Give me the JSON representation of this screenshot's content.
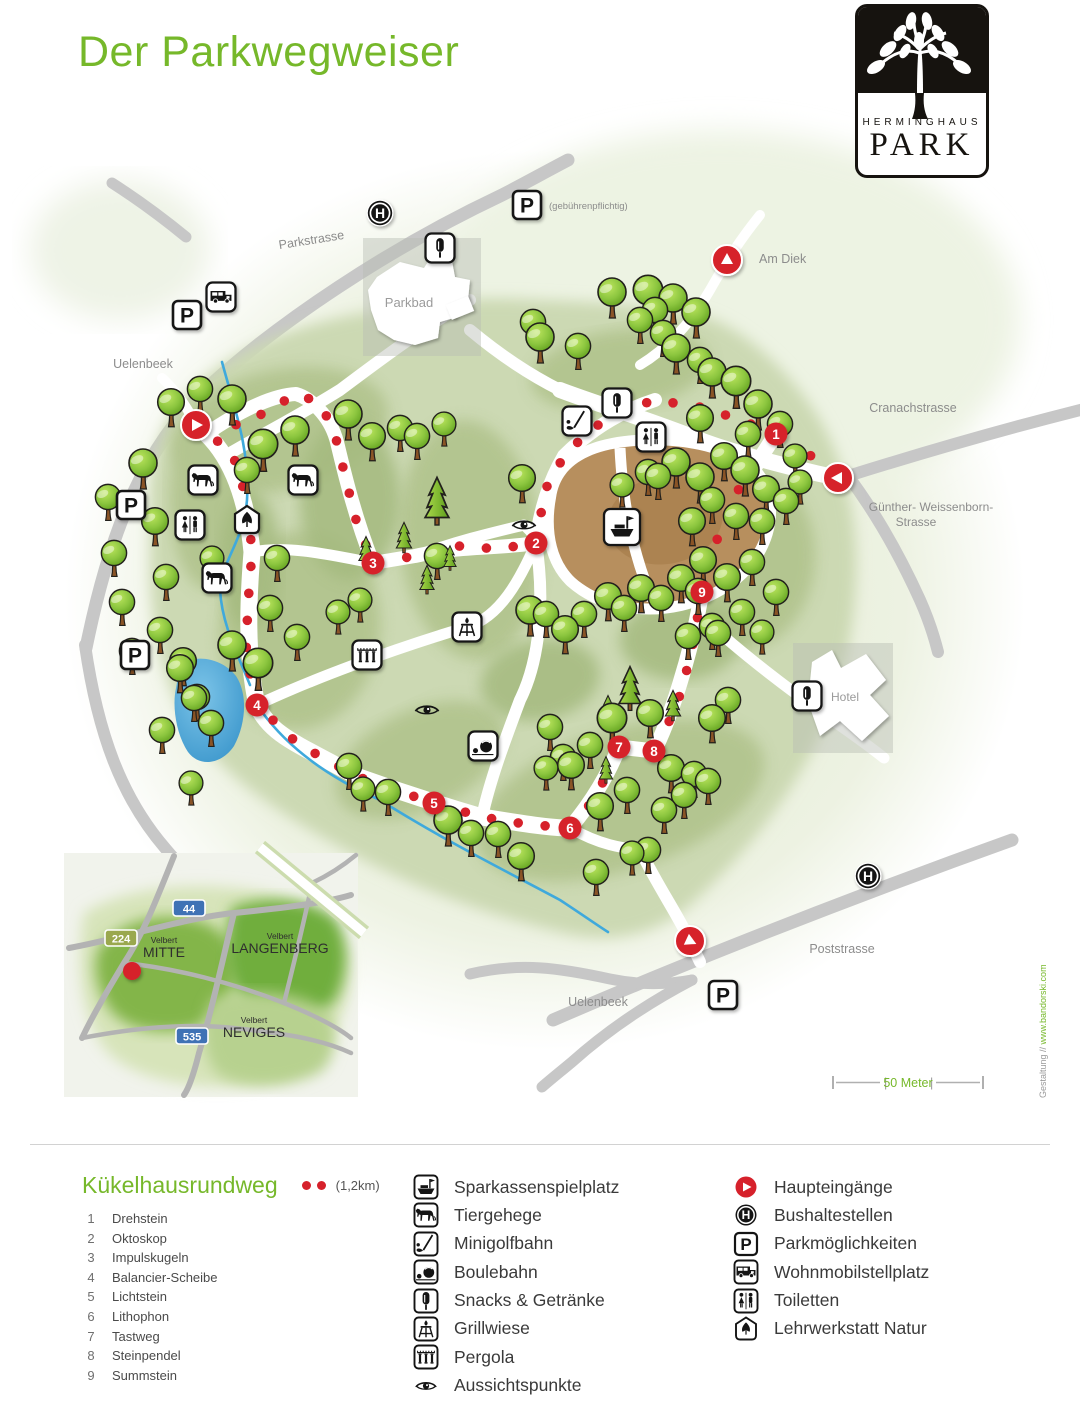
{
  "page": {
    "title": "Der Parkwegweiser"
  },
  "logo": {
    "line1": "HERMINGHAUS",
    "line2": "PARK"
  },
  "colors": {
    "accent_green": "#76b82a",
    "marker_red": "#d6212b",
    "road_gray": "#c7c7c7",
    "park_green": "#ccd9b3",
    "playground_brown": "#b78f5e",
    "stream_blue": "#3fa9dc"
  },
  "map": {
    "labels": [
      {
        "name": "street-label-parkstrasse",
        "text": "Parkstrasse",
        "x": 312,
        "y": 244,
        "rot": -9,
        "size": 12.5
      },
      {
        "name": "parking-fee-note",
        "text": "(gebührenpflichtig)",
        "x": 549,
        "y": 209,
        "size": 9.5,
        "anchor": "start"
      },
      {
        "name": "street-label-am-diek",
        "text": "Am Diek",
        "x": 759,
        "y": 263,
        "size": 12.5,
        "anchor": "start"
      },
      {
        "name": "street-label-cranachstrasse",
        "text": "Cranachstrasse",
        "x": 913,
        "y": 412,
        "size": 12.5
      },
      {
        "name": "street-label-guenther-weissenborn-1",
        "text": "Günther- Weissenborn-",
        "x": 931,
        "y": 511,
        "size": 12
      },
      {
        "name": "street-label-guenther-weissenborn-2",
        "text": "Strasse",
        "x": 916,
        "y": 526,
        "size": 12
      },
      {
        "name": "street-label-uelenbeek-north",
        "text": "Uelenbeek",
        "x": 143,
        "y": 368,
        "size": 12.5
      },
      {
        "name": "street-label-uelenbeek-south",
        "text": "Uelenbeek",
        "x": 598,
        "y": 1006,
        "size": 12.5
      },
      {
        "name": "street-label-poststrasse",
        "text": "Poststrasse",
        "x": 842,
        "y": 953,
        "size": 12.5
      },
      {
        "name": "area-label-parkbad",
        "text": "Parkbad",
        "x": 409,
        "y": 307,
        "size": 13,
        "color": "#9b9b9b"
      },
      {
        "name": "area-label-hotel",
        "text": "Hotel",
        "x": 831,
        "y": 701,
        "size": 12,
        "color": "#9b9b9b",
        "anchor": "start"
      }
    ],
    "entrances": [
      {
        "x": 196,
        "y": 425,
        "dir": 0
      },
      {
        "x": 727,
        "y": 260,
        "dir": -90
      },
      {
        "x": 838,
        "y": 478,
        "dir": 180
      },
      {
        "x": 690,
        "y": 941,
        "dir": 25
      }
    ],
    "bus_stops": [
      {
        "x": 380,
        "y": 213
      },
      {
        "x": 868,
        "y": 876
      }
    ],
    "parking_signs": [
      {
        "x": 187,
        "y": 315
      },
      {
        "x": 527,
        "y": 205
      },
      {
        "x": 131,
        "y": 505
      },
      {
        "x": 135,
        "y": 655
      },
      {
        "x": 723,
        "y": 995
      }
    ],
    "camper_signs": [
      {
        "x": 221,
        "y": 297
      }
    ],
    "stations": [
      {
        "n": "1",
        "x": 776,
        "y": 434
      },
      {
        "n": "2",
        "x": 536,
        "y": 543
      },
      {
        "n": "3",
        "x": 373,
        "y": 563
      },
      {
        "n": "4",
        "x": 257,
        "y": 705
      },
      {
        "n": "5",
        "x": 434,
        "y": 803
      },
      {
        "n": "6",
        "x": 570,
        "y": 828
      },
      {
        "n": "7",
        "x": 619,
        "y": 747
      },
      {
        "n": "8",
        "x": 654,
        "y": 751
      },
      {
        "n": "9",
        "x": 702,
        "y": 592
      }
    ],
    "icons": [
      {
        "type": "snacks",
        "x": 440,
        "y": 248,
        "boxed": true
      },
      {
        "type": "snacks",
        "x": 617,
        "y": 403,
        "boxed": true
      },
      {
        "type": "snacks",
        "x": 807,
        "y": 696,
        "boxed": true
      },
      {
        "type": "golf",
        "x": 577,
        "y": 421,
        "boxed": true
      },
      {
        "type": "toilets",
        "x": 651,
        "y": 437,
        "boxed": true
      },
      {
        "type": "toilets",
        "x": 190,
        "y": 525,
        "boxed": true
      },
      {
        "type": "horse",
        "x": 203,
        "y": 480,
        "boxed": true
      },
      {
        "type": "horse",
        "x": 303,
        "y": 480,
        "boxed": true
      },
      {
        "type": "horse",
        "x": 217,
        "y": 578,
        "boxed": true
      },
      {
        "type": "leaf",
        "x": 247,
        "y": 520,
        "boxed": false
      },
      {
        "type": "ship",
        "x": 622,
        "y": 527,
        "boxed": true,
        "big": true
      },
      {
        "type": "grill",
        "x": 467,
        "y": 627,
        "boxed": true
      },
      {
        "type": "pergola",
        "x": 367,
        "y": 655,
        "boxed": true
      },
      {
        "type": "boule",
        "x": 483,
        "y": 746,
        "boxed": true
      },
      {
        "type": "eye",
        "x": 524,
        "y": 525,
        "boxed": false
      },
      {
        "type": "eye",
        "x": 427,
        "y": 710,
        "boxed": false
      }
    ],
    "trail": {
      "spacing": 27,
      "lines": [
        [
          [
            196,
            425
          ],
          [
            232,
            452
          ],
          [
            247,
            500
          ],
          [
            252,
            552
          ],
          [
            248,
            603
          ],
          [
            246,
            655
          ],
          [
            257,
            705
          ],
          [
            298,
            744
          ],
          [
            356,
            776
          ],
          [
            395,
            790
          ],
          [
            434,
            803
          ],
          [
            482,
            817
          ],
          [
            525,
            824
          ],
          [
            570,
            828
          ],
          [
            596,
            797
          ],
          [
            619,
            747
          ],
          [
            654,
            751
          ],
          [
            676,
            708
          ],
          [
            691,
            655
          ],
          [
            702,
            592
          ],
          [
            716,
            542
          ],
          [
            737,
            492
          ],
          [
            758,
            461
          ],
          [
            776,
            434
          ],
          [
            806,
            452
          ],
          [
            838,
            478
          ]
        ],
        [
          [
            776,
            434
          ],
          [
            738,
            419
          ],
          [
            700,
            407
          ],
          [
            655,
            400
          ],
          [
            618,
            412
          ],
          [
            589,
            431
          ],
          [
            564,
            456
          ],
          [
            545,
            490
          ],
          [
            536,
            543
          ],
          [
            498,
            549
          ],
          [
            458,
            546
          ],
          [
            415,
            556
          ],
          [
            373,
            563
          ],
          [
            356,
            520
          ],
          [
            346,
            480
          ],
          [
            337,
            442
          ],
          [
            321,
            403
          ],
          [
            296,
            394
          ],
          [
            262,
            414
          ],
          [
            228,
            428
          ]
        ]
      ]
    },
    "trees": [
      [
        108,
        497,
        0.9
      ],
      [
        114,
        553,
        0.9
      ],
      [
        122,
        602,
        0.9
      ],
      [
        132,
        651,
        0.9
      ],
      [
        143,
        463,
        1
      ],
      [
        155,
        521,
        0.95
      ],
      [
        166,
        577,
        0.9
      ],
      [
        160,
        630,
        0.9
      ],
      [
        180,
        668,
        0.95
      ],
      [
        197,
        697,
        0.9
      ],
      [
        171,
        402,
        0.95
      ],
      [
        200,
        389,
        0.9
      ],
      [
        232,
        399,
        1
      ],
      [
        263,
        444,
        1.05
      ],
      [
        295,
        430,
        1
      ],
      [
        247,
        470,
        0.9
      ],
      [
        277,
        558,
        0.9
      ],
      [
        212,
        558,
        0.85
      ],
      [
        348,
        414,
        1
      ],
      [
        372,
        436,
        0.95
      ],
      [
        400,
        428,
        0.9
      ],
      [
        417,
        436,
        0.9
      ],
      [
        444,
        424,
        0.85
      ],
      [
        522,
        478,
        0.95
      ],
      [
        540,
        337,
        1
      ],
      [
        578,
        346,
        0.9
      ],
      [
        533,
        322,
        0.9
      ],
      [
        612,
        292,
        1
      ],
      [
        648,
        290,
        1.05
      ],
      [
        673,
        298,
        1
      ],
      [
        696,
        312,
        1
      ],
      [
        640,
        320,
        0.9
      ],
      [
        663,
        333,
        0.9
      ],
      [
        655,
        310,
        0.9
      ],
      [
        676,
        348,
        1
      ],
      [
        700,
        360,
        0.9
      ],
      [
        712,
        372,
        1
      ],
      [
        736,
        381,
        1.05
      ],
      [
        758,
        404,
        1
      ],
      [
        700,
        418,
        0.95
      ],
      [
        780,
        424,
        0.9
      ],
      [
        676,
        462,
        1
      ],
      [
        700,
        477,
        1
      ],
      [
        724,
        456,
        0.95
      ],
      [
        745,
        470,
        1
      ],
      [
        766,
        489,
        0.95
      ],
      [
        712,
        500,
        0.9
      ],
      [
        692,
        521,
        0.95
      ],
      [
        736,
        516,
        0.9
      ],
      [
        762,
        521,
        0.9
      ],
      [
        786,
        501,
        0.9
      ],
      [
        658,
        476,
        0.9
      ],
      [
        800,
        482,
        0.85
      ],
      [
        748,
        434,
        0.9
      ],
      [
        795,
        456,
        0.85
      ],
      [
        648,
        472,
        0.9
      ],
      [
        622,
        485,
        0.85
      ],
      [
        703,
        560,
        0.95
      ],
      [
        727,
        577,
        0.95
      ],
      [
        752,
        562,
        0.9
      ],
      [
        776,
        592,
        0.9
      ],
      [
        742,
        612,
        0.9
      ],
      [
        712,
        626,
        0.9
      ],
      [
        762,
        632,
        0.85
      ],
      [
        688,
        636,
        0.9
      ],
      [
        530,
        610,
        1
      ],
      [
        546,
        614,
        0.9
      ],
      [
        565,
        629,
        0.95
      ],
      [
        584,
        614,
        0.9
      ],
      [
        608,
        596,
        0.95
      ],
      [
        624,
        608,
        0.9
      ],
      [
        641,
        588,
        0.95
      ],
      [
        661,
        598,
        0.9
      ],
      [
        681,
        578,
        0.95
      ],
      [
        698,
        591,
        0.9
      ],
      [
        612,
        718,
        1.05
      ],
      [
        650,
        713,
        0.95
      ],
      [
        590,
        745,
        0.9
      ],
      [
        571,
        765,
        0.95
      ],
      [
        600,
        806,
        0.95
      ],
      [
        627,
        790,
        0.9
      ],
      [
        648,
        850,
        0.9
      ],
      [
        632,
        853,
        0.85
      ],
      [
        596,
        872,
        0.9
      ],
      [
        664,
        810,
        0.9
      ],
      [
        671,
        768,
        0.95
      ],
      [
        694,
        774,
        0.9
      ],
      [
        712,
        718,
        0.95
      ],
      [
        728,
        700,
        0.9
      ],
      [
        718,
        633,
        0.9
      ],
      [
        684,
        795,
        0.9
      ],
      [
        708,
        781,
        0.9
      ],
      [
        349,
        766,
        0.9
      ],
      [
        363,
        789,
        0.85
      ],
      [
        388,
        792,
        0.9
      ],
      [
        448,
        820,
        1
      ],
      [
        471,
        833,
        0.9
      ],
      [
        498,
        834,
        0.9
      ],
      [
        521,
        856,
        0.95
      ],
      [
        550,
        727,
        0.9
      ],
      [
        563,
        757,
        0.9
      ],
      [
        546,
        768,
        0.85
      ],
      [
        232,
        645,
        1
      ],
      [
        258,
        663,
        1.05
      ],
      [
        183,
        661,
        0.95
      ],
      [
        194,
        698,
        0.9
      ],
      [
        211,
        723,
        0.9
      ],
      [
        162,
        730,
        0.9
      ],
      [
        191,
        783,
        0.85
      ],
      [
        297,
        637,
        0.9
      ],
      [
        270,
        608,
        0.9
      ],
      [
        338,
        612,
        0.85
      ],
      [
        360,
        600,
        0.85
      ],
      [
        437,
        556,
        0.9
      ]
    ],
    "conifers": [
      [
        437,
        505,
        1.25
      ],
      [
        404,
        540,
        0.8
      ],
      [
        366,
        553,
        0.75
      ],
      [
        427,
        582,
        0.75
      ],
      [
        450,
        560,
        0.65
      ],
      [
        630,
        692,
        1.15
      ],
      [
        608,
        712,
        0.75
      ],
      [
        673,
        708,
        0.8
      ],
      [
        606,
        772,
        0.7
      ]
    ],
    "inset": {
      "labels": [
        {
          "name": "inset-label-velbert-mitte-top",
          "text": "Velbert",
          "x": 100,
          "y": 90,
          "size": 8.5
        },
        {
          "name": "inset-label-velbert-mitte",
          "text": "MITTE",
          "x": 100,
          "y": 104,
          "size": 14
        },
        {
          "name": "inset-label-velbert-langenberg-top",
          "text": "Velbert",
          "x": 216,
          "y": 86,
          "size": 8.5
        },
        {
          "name": "inset-label-velbert-langenberg",
          "text": "LANGENBERG",
          "x": 216,
          "y": 100,
          "size": 14
        },
        {
          "name": "inset-label-velbert-neviges-top",
          "text": "Velbert",
          "x": 190,
          "y": 170,
          "size": 8.5
        },
        {
          "name": "inset-label-velbert-neviges",
          "text": "NEVIGES",
          "x": 190,
          "y": 184,
          "size": 14
        }
      ],
      "signs": [
        {
          "text": "44",
          "x": 125,
          "y": 55,
          "style": "blue"
        },
        {
          "text": "224",
          "x": 57,
          "y": 85,
          "style": "green"
        },
        {
          "text": "535",
          "x": 128,
          "y": 183,
          "style": "blue"
        }
      ],
      "marker": {
        "x": 68,
        "y": 118
      }
    },
    "scale": {
      "label": "50 Meter"
    },
    "credit": {
      "gray": "Gestaltung // ",
      "green": "www.bandorski.com"
    }
  },
  "legend": {
    "col1": {
      "title": "Kükelhausrundweg",
      "distance": "(1,2km)",
      "items": [
        {
          "num": "1",
          "label": "Drehstein"
        },
        {
          "num": "2",
          "label": "Oktoskop"
        },
        {
          "num": "3",
          "label": "Impulskugeln"
        },
        {
          "num": "4",
          "label": "Balancier-Scheibe"
        },
        {
          "num": "5",
          "label": "Lichtstein"
        },
        {
          "num": "6",
          "label": "Lithophon"
        },
        {
          "num": "7",
          "label": "Tastweg"
        },
        {
          "num": "8",
          "label": "Steinpendel"
        },
        {
          "num": "9",
          "label": "Summstein"
        }
      ]
    },
    "col2": [
      {
        "icon": "ship",
        "label": "Sparkassenspielplatz",
        "boxed": true
      },
      {
        "icon": "horse",
        "label": "Tiergehege",
        "boxed": true
      },
      {
        "icon": "golf",
        "label": "Minigolfbahn",
        "boxed": true
      },
      {
        "icon": "boule",
        "label": "Boulebahn",
        "boxed": true
      },
      {
        "icon": "snacks",
        "label": "Snacks & Getränke",
        "boxed": true
      },
      {
        "icon": "grill",
        "label": "Grillwiese",
        "boxed": true
      },
      {
        "icon": "pergola",
        "label": "Pergola",
        "boxed": true
      },
      {
        "icon": "eye",
        "label": "Aussichtspunkte",
        "boxed": false
      }
    ],
    "col3": [
      {
        "icon": "entrance",
        "label": "Haupteingänge",
        "boxed": false
      },
      {
        "icon": "busstop",
        "label": "Bushaltestellen",
        "boxed": false
      },
      {
        "icon": "parking",
        "label": "Parkmöglichkeiten",
        "boxed": false
      },
      {
        "icon": "camper",
        "label": "Wohnmobilstellplatz",
        "boxed": true
      },
      {
        "icon": "toilets",
        "label": "Toiletten",
        "boxed": true
      },
      {
        "icon": "leaf",
        "label": "Lehrwerkstatt Natur",
        "boxed": false
      }
    ]
  }
}
